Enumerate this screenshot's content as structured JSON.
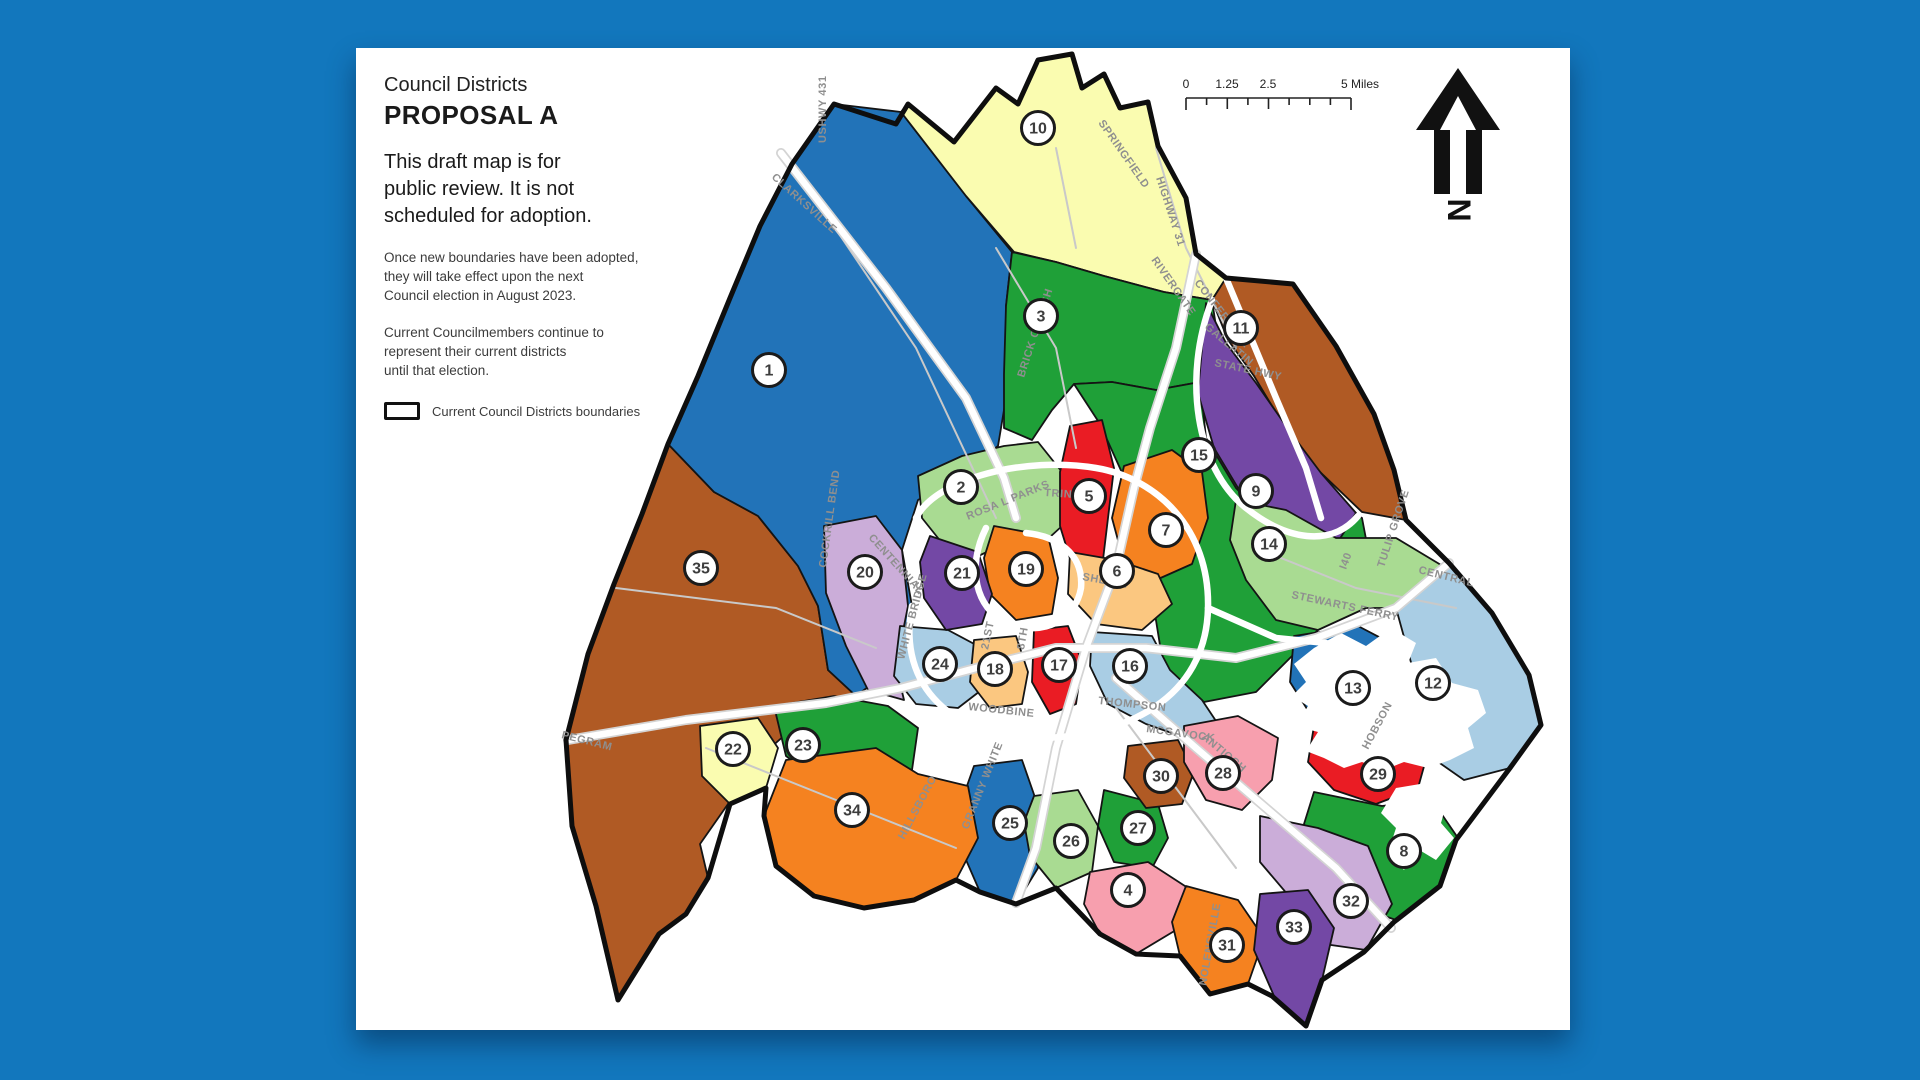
{
  "page": {
    "background_color": "#1277bd",
    "paper_color": "#ffffff"
  },
  "header": {
    "kicker": "Council Districts",
    "title": "PROPOSAL A",
    "lead": {
      "l1": "This draft map is for",
      "l2": "public review. It is not",
      "l3": "scheduled for adoption."
    },
    "adoption": {
      "l1": "Once new boundaries have been adopted,",
      "l2": "they will take effect upon the next",
      "l3": "Council election in August 2023."
    },
    "current": {
      "l1": "Current Councilmembers continue to",
      "l2": "represent their current districts",
      "l3": "until that election."
    },
    "legend_label": "Current Council Districts boundaries"
  },
  "scale_bar": {
    "t0": "0",
    "t1": "1.25",
    "t2": "2.5",
    "t3": "5 Miles"
  },
  "north_arrow": {
    "letter": "N"
  },
  "map": {
    "palette": {
      "blue": "#2273b8",
      "light_blue": "#a9cde4",
      "green": "#1fa038",
      "light_green": "#a9db92",
      "pale_yellow": "#fafcb0",
      "sienna": "#b05a24",
      "purple": "#7348a5",
      "plum": "#cbadd9",
      "red": "#ea1c24",
      "orange": "#f58220",
      "tan": "#fbc780",
      "pink": "#f79fae"
    },
    "districts": [
      {
        "n": 1,
        "c": "blue",
        "x": 413,
        "y": 322
      },
      {
        "n": 2,
        "c": "light_green",
        "x": 605,
        "y": 439
      },
      {
        "n": 3,
        "c": "green",
        "x": 685,
        "y": 268
      },
      {
        "n": 4,
        "c": "pink",
        "x": 772,
        "y": 842
      },
      {
        "n": 5,
        "c": "red",
        "x": 733,
        "y": 448
      },
      {
        "n": 6,
        "c": "tan",
        "x": 761,
        "y": 523
      },
      {
        "n": 7,
        "c": "orange",
        "x": 810,
        "y": 482
      },
      {
        "n": 8,
        "c": "green",
        "x": 1048,
        "y": 803
      },
      {
        "n": 9,
        "c": "purple",
        "x": 900,
        "y": 443
      },
      {
        "n": 10,
        "c": "pale_yellow",
        "x": 682,
        "y": 80
      },
      {
        "n": 11,
        "c": "sienna",
        "x": 885,
        "y": 280
      },
      {
        "n": 12,
        "c": "light_blue",
        "x": 1077,
        "y": 635
      },
      {
        "n": 13,
        "c": "blue",
        "x": 997,
        "y": 640
      },
      {
        "n": 14,
        "c": "light_green",
        "x": 913,
        "y": 496
      },
      {
        "n": 15,
        "c": "green",
        "x": 843,
        "y": 407
      },
      {
        "n": 16,
        "c": "light_blue",
        "x": 774,
        "y": 618
      },
      {
        "n": 17,
        "c": "red",
        "x": 703,
        "y": 617
      },
      {
        "n": 18,
        "c": "tan",
        "x": 639,
        "y": 621
      },
      {
        "n": 19,
        "c": "orange",
        "x": 670,
        "y": 521
      },
      {
        "n": 20,
        "c": "plum",
        "x": 509,
        "y": 524
      },
      {
        "n": 21,
        "c": "purple",
        "x": 606,
        "y": 525
      },
      {
        "n": 22,
        "c": "pale_yellow",
        "x": 377,
        "y": 701
      },
      {
        "n": 23,
        "c": "green",
        "x": 447,
        "y": 697
      },
      {
        "n": 24,
        "c": "light_blue",
        "x": 584,
        "y": 616
      },
      {
        "n": 25,
        "c": "blue",
        "x": 654,
        "y": 775
      },
      {
        "n": 26,
        "c": "light_green",
        "x": 715,
        "y": 793
      },
      {
        "n": 27,
        "c": "green",
        "x": 782,
        "y": 780
      },
      {
        "n": 28,
        "c": "pink",
        "x": 867,
        "y": 725
      },
      {
        "n": 29,
        "c": "red",
        "x": 1022,
        "y": 726
      },
      {
        "n": 30,
        "c": "sienna",
        "x": 805,
        "y": 728
      },
      {
        "n": 31,
        "c": "orange",
        "x": 871,
        "y": 897
      },
      {
        "n": 32,
        "c": "plum",
        "x": 995,
        "y": 853
      },
      {
        "n": 33,
        "c": "purple",
        "x": 938,
        "y": 879
      },
      {
        "n": 34,
        "c": "orange",
        "x": 496,
        "y": 762
      },
      {
        "n": 35,
        "c": "sienna",
        "x": 345,
        "y": 520
      }
    ],
    "road_labels": [
      {
        "text": "USHWY 431",
        "x": 470,
        "y": 95,
        "rot": -90
      },
      {
        "text": "CLARKSVILLE",
        "x": 415,
        "y": 130,
        "rot": 42
      },
      {
        "text": "SPRINGFIELD",
        "x": 742,
        "y": 75,
        "rot": 55
      },
      {
        "text": "HIGHWAY 31",
        "x": 800,
        "y": 130,
        "rot": 72
      },
      {
        "text": "RIVERGATE",
        "x": 795,
        "y": 212,
        "rot": 55
      },
      {
        "text": "CONFERENCE",
        "x": 838,
        "y": 235,
        "rot": 52
      },
      {
        "text": "GALLATIN",
        "x": 848,
        "y": 280,
        "rot": 40
      },
      {
        "text": "STATE HWY",
        "x": 858,
        "y": 318,
        "rot": 12
      },
      {
        "text": "BRICK CHURCH",
        "x": 668,
        "y": 330,
        "rot": -72
      },
      {
        "text": "TRINITY",
        "x": 688,
        "y": 448,
        "rot": 4
      },
      {
        "text": "ROSA L PARKS",
        "x": 612,
        "y": 472,
        "rot": -22
      },
      {
        "text": "CENTENNIAL",
        "x": 512,
        "y": 490,
        "rot": 48
      },
      {
        "text": "COCKRILL BEND",
        "x": 470,
        "y": 520,
        "rot": -82
      },
      {
        "text": "WHITE BRIDGE",
        "x": 548,
        "y": 612,
        "rot": -75
      },
      {
        "text": "21ST",
        "x": 632,
        "y": 602,
        "rot": -78
      },
      {
        "text": "8TH",
        "x": 668,
        "y": 602,
        "rot": -80
      },
      {
        "text": "SHELBY",
        "x": 726,
        "y": 532,
        "rot": 10
      },
      {
        "text": "STEWARTS FERRY",
        "x": 935,
        "y": 550,
        "rot": 12
      },
      {
        "text": "I40",
        "x": 990,
        "y": 522,
        "rot": -70
      },
      {
        "text": "TULIP GROVE",
        "x": 1028,
        "y": 520,
        "rot": -72
      },
      {
        "text": "CENTRAL",
        "x": 1062,
        "y": 525,
        "rot": 14
      },
      {
        "text": "HOBSON",
        "x": 1012,
        "y": 702,
        "rot": -62
      },
      {
        "text": "THOMPSON",
        "x": 742,
        "y": 656,
        "rot": 6
      },
      {
        "text": "MCGAVOCK",
        "x": 790,
        "y": 684,
        "rot": 8
      },
      {
        "text": "ANTIOCH",
        "x": 845,
        "y": 690,
        "rot": 40
      },
      {
        "text": "NOLENSVILLE",
        "x": 850,
        "y": 938,
        "rot": -80
      },
      {
        "text": "HILLSBORO",
        "x": 548,
        "y": 792,
        "rot": -62
      },
      {
        "text": "GRANNY WHITE",
        "x": 612,
        "y": 782,
        "rot": -68
      },
      {
        "text": "WOODBINE",
        "x": 612,
        "y": 662,
        "rot": 6
      },
      {
        "text": "PEGRAM",
        "x": 205,
        "y": 690,
        "rot": 14
      }
    ]
  }
}
